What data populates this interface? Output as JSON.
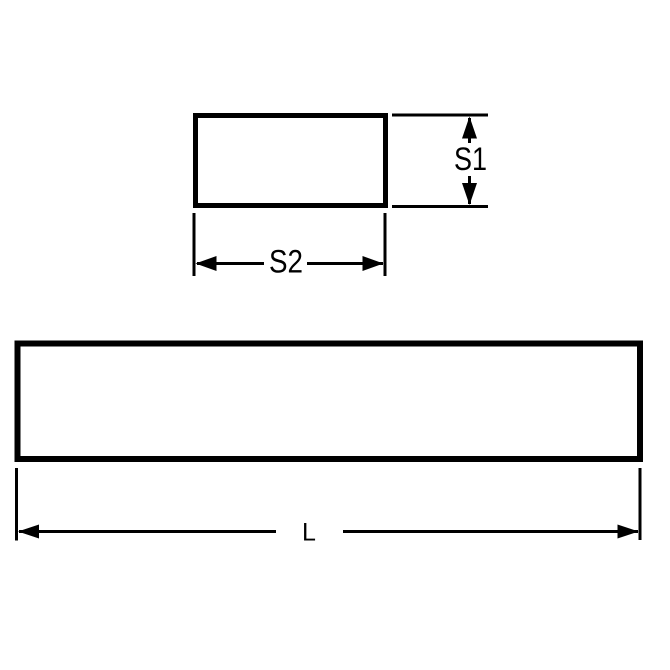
{
  "drawing": {
    "background_color": "#ffffff",
    "line_color": "#000000",
    "cross_section_view": {
      "height_label": "S1",
      "width_label": "S2"
    },
    "side_view": {
      "length_label": "L"
    }
  }
}
